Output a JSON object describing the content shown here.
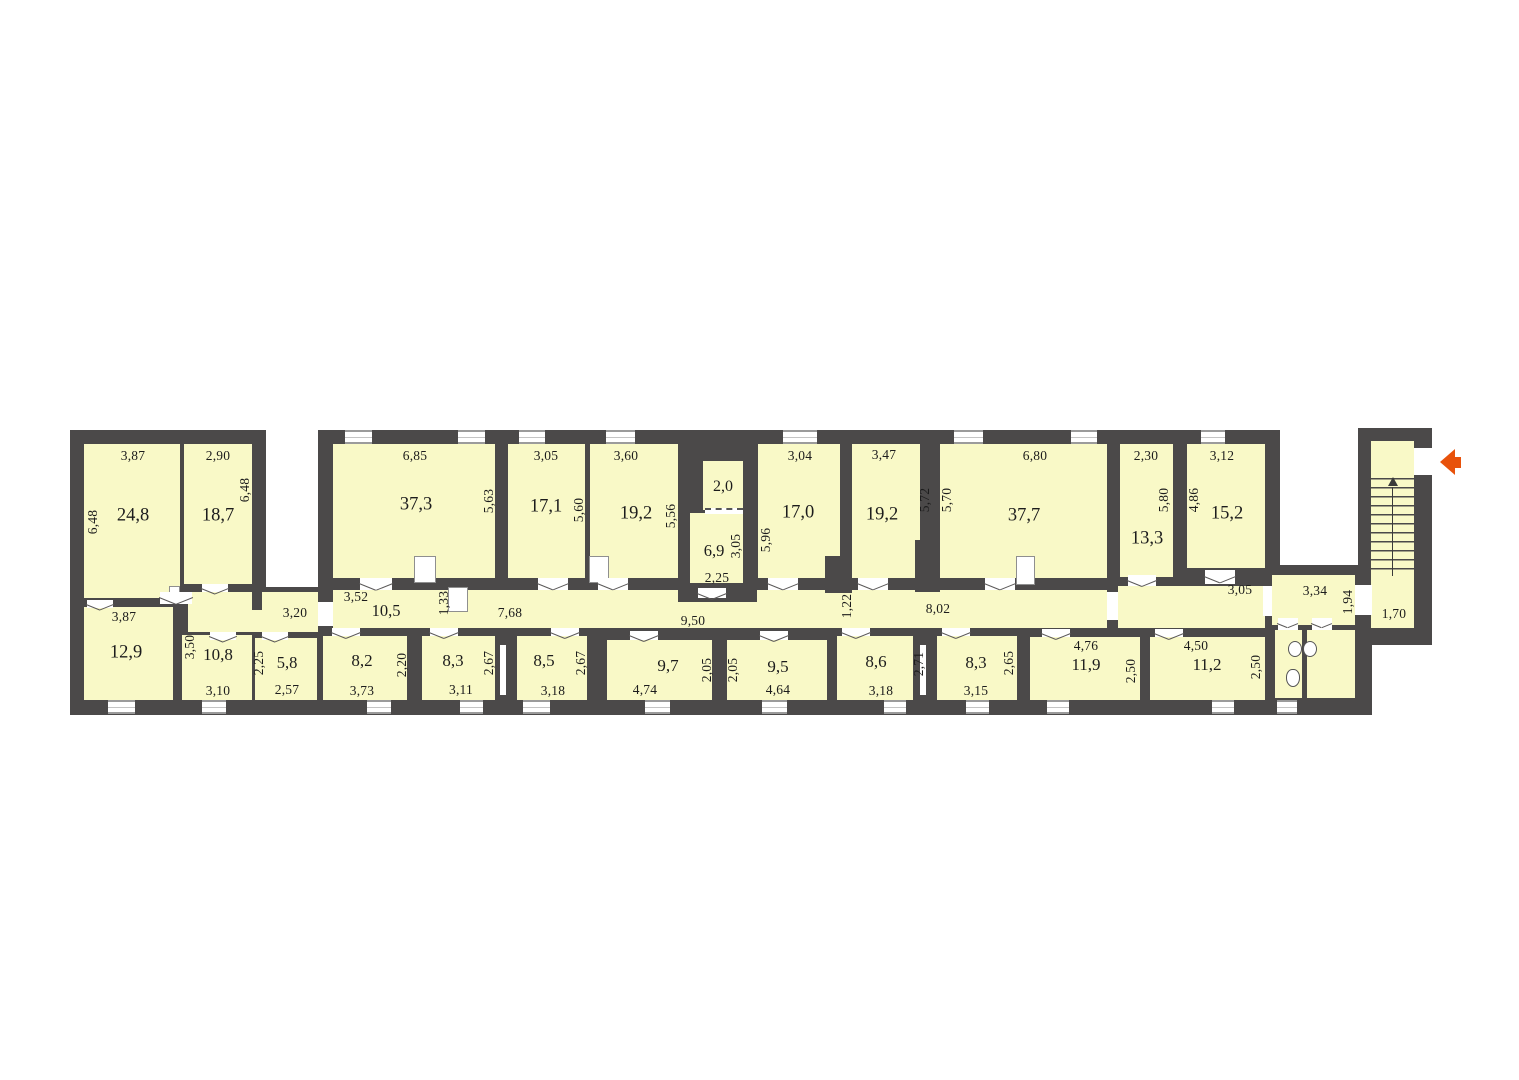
{
  "colors": {
    "wall": "#4b4949",
    "room_fill": "#f9f9c7",
    "entry_arrow": "#e8520b",
    "text": "#1c1c1c"
  },
  "rooms": {
    "r24_8": {
      "area": "24,8",
      "w": "3,87",
      "h": "6,48"
    },
    "r18_7": {
      "area": "18,7",
      "w": "2,90",
      "h": "6,48"
    },
    "r37_3": {
      "area": "37,3",
      "w": "6,85",
      "h": "5,63"
    },
    "r17_1": {
      "area": "17,1",
      "w": "3,05",
      "h": "5,60"
    },
    "r19_2a": {
      "area": "19,2",
      "w": "3,60",
      "h": "5,56"
    },
    "r2_0": {
      "area": "2,0"
    },
    "r6_9": {
      "area": "6,9",
      "w": "2,25",
      "h": "3,05"
    },
    "r17_0": {
      "area": "17,0",
      "w": "3,04",
      "h": "5,96"
    },
    "r19_2b": {
      "area": "19,2",
      "w": "3,47",
      "h": "5,72"
    },
    "r37_7": {
      "area": "37,7",
      "w": "6,80",
      "h": "5,70"
    },
    "r13_3": {
      "area": "13,3",
      "w": "2,30",
      "h": "5,80"
    },
    "r15_2": {
      "area": "15,2",
      "w": "3,12",
      "h": "4,86"
    },
    "r12_9": {
      "area": "12,9",
      "w": "3,87"
    },
    "r10_8": {
      "area": "10,8",
      "w": "3,10",
      "h": "3,50"
    },
    "r5_8": {
      "area": "5,8",
      "w": "2,57",
      "h": "2,25"
    },
    "r8_2": {
      "area": "8,2",
      "w": "3,73",
      "h": "2,20"
    },
    "r8_3a": {
      "area": "8,3",
      "w": "3,11",
      "h": "2,67"
    },
    "r8_5": {
      "area": "8,5",
      "w": "3,18",
      "h": "2,67"
    },
    "r9_7": {
      "area": "9,7",
      "w": "4,74",
      "h": "2,05"
    },
    "r9_5": {
      "area": "9,5",
      "w": "4,64",
      "h": "2,05"
    },
    "r8_6": {
      "area": "8,6",
      "w": "3,18",
      "h": "2,71"
    },
    "r8_3b": {
      "area": "8,3",
      "w": "3,15",
      "h": "2,65"
    },
    "r11_9": {
      "area": "11,9",
      "w": "4,76",
      "h": "2,50"
    },
    "r11_2": {
      "area": "11,2",
      "w": "4,50",
      "h": "2,50"
    }
  },
  "corridor": {
    "area": "10,5",
    "d1": "3,20",
    "d2": "3,52",
    "d3": "1,33",
    "d4": "7,68",
    "d5": "9,50",
    "d6": "1,22",
    "d7": "8,02",
    "d8": "3,05"
  },
  "hall": {
    "area": "3,34",
    "h": "1,94"
  },
  "stair": {
    "w": "1,70"
  }
}
